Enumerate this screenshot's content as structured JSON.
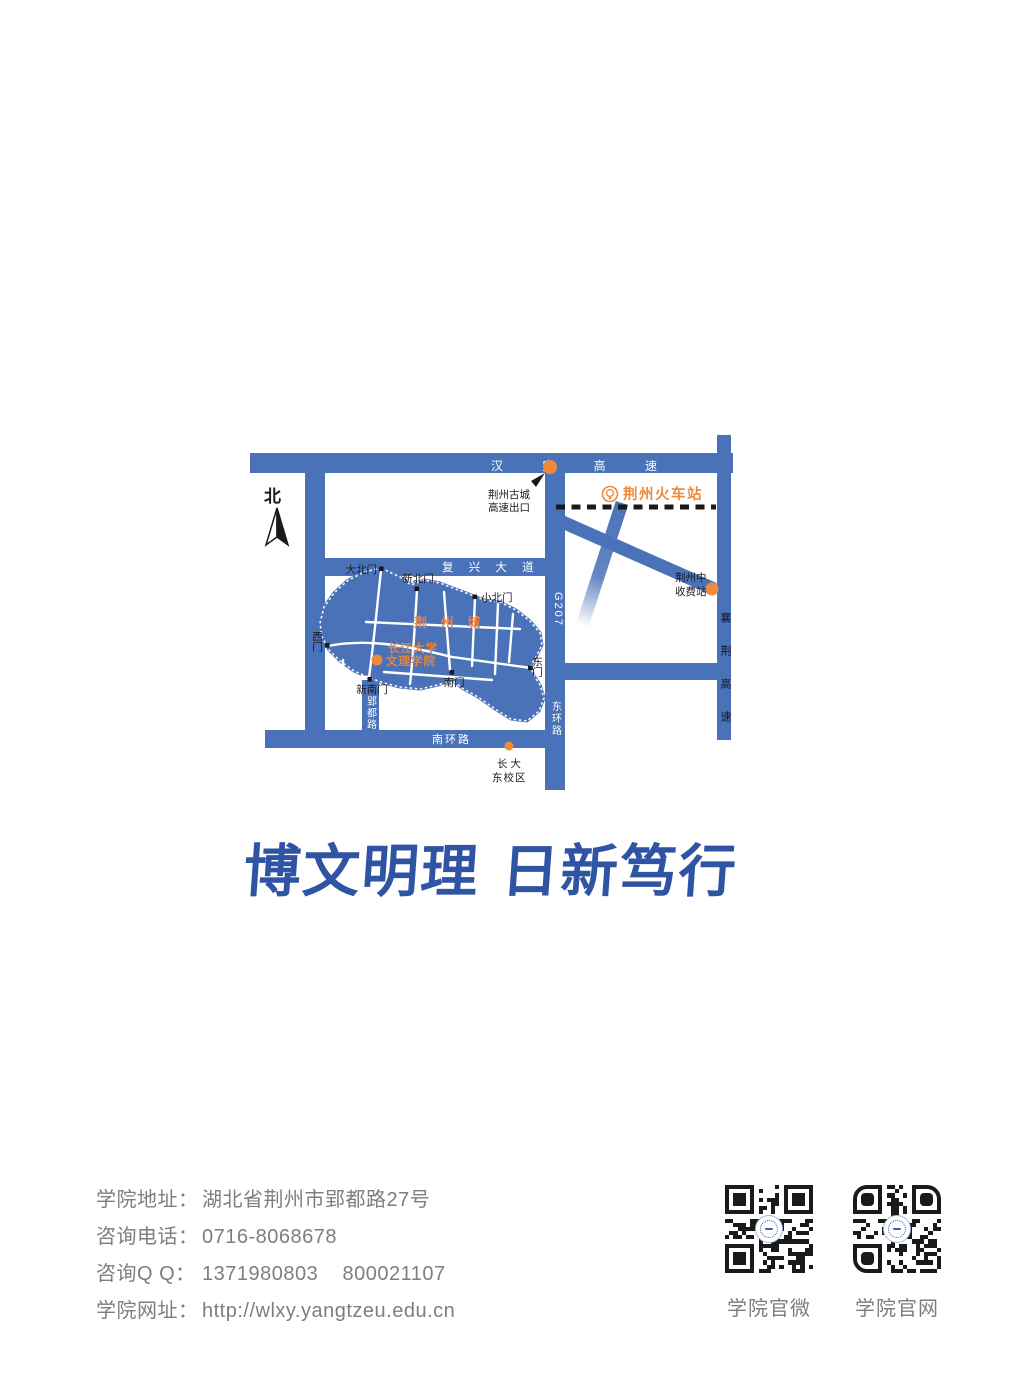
{
  "map": {
    "compass": "北",
    "colors": {
      "road_blue": "#4a72b8",
      "accent_orange": "#ee8a3c",
      "label_black": "#1a1a1a",
      "street_white": "#ffffff"
    },
    "roads": {
      "hanyi_expressway": "汉 宜 高 速",
      "fuxing_avenue": "复 兴 大 道",
      "south_ring": "南环路",
      "yingdu_road": "郢都路",
      "g207": "G207",
      "east_ring": "东环路",
      "xiangjing_expressway": "襄荆高速"
    },
    "labels": {
      "exit_line1": "荆州古城",
      "exit_line2": "高速出口",
      "railway_station": "荆州火车站",
      "toll_line1": "荆州中",
      "toll_line2": "收费站",
      "city_name": "荆 州 城",
      "college_line1": "长江大学",
      "college_line2": "文理学院",
      "campus_line1": "长 大",
      "campus_line2": "东校区"
    },
    "gates": {
      "big_north": "大北门",
      "new_north": "新北门",
      "small_north": "小北门",
      "west": "西门",
      "new_south": "新南门",
      "south": "南门",
      "east": "东门"
    }
  },
  "motto": {
    "part1": "博文明理",
    "part2": "日新笃行",
    "color": "#2e54a3"
  },
  "contact": {
    "rows": [
      {
        "label": "学院地址：",
        "value": "湖北省荆州市郢都路27号"
      },
      {
        "label": "咨询电话：",
        "value": "0716-8068678"
      },
      {
        "label": "咨询Q Q：",
        "value": "1371980803    800021107"
      },
      {
        "label": "学院网址：",
        "value": "http://wlxy.yangtzeu.edu.cn"
      }
    ]
  },
  "qr": {
    "wechat_label": "学院官微",
    "website_label": "学院官网"
  }
}
